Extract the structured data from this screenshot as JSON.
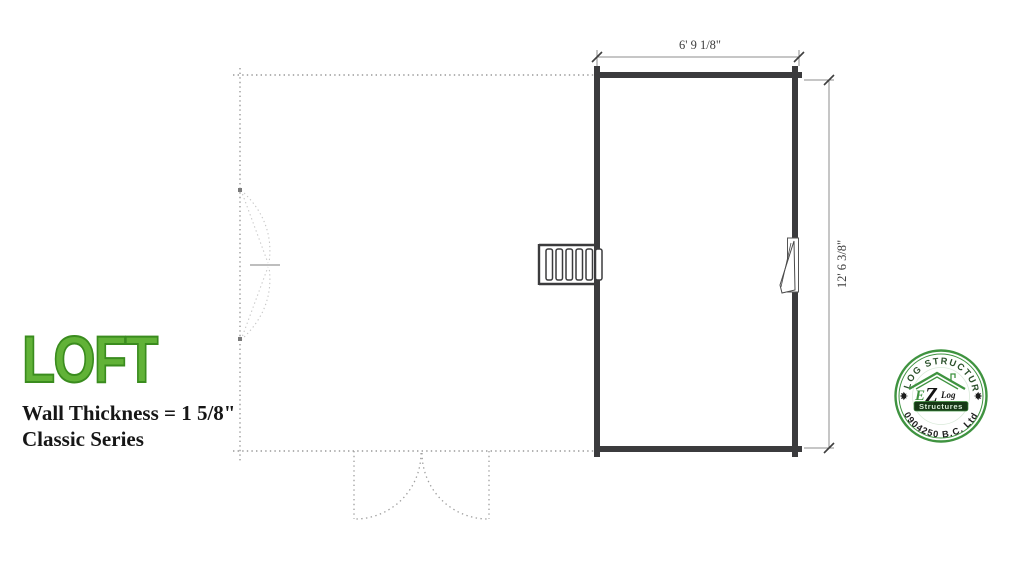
{
  "title": {
    "main": "LOFT",
    "wall_thickness": "Wall Thickness = 1 5/8\"",
    "series": "Classic Series"
  },
  "plan": {
    "dim_top": "6' 9 1/8\"",
    "dim_right": "12' 6 3/8\""
  },
  "stamp": {
    "arc_top": "EZ LOG STRUCTURES",
    "arc_bottom": "0904250 B.C. Ltd",
    "e": "E",
    "z": "Z",
    "log": "Log",
    "banner": "Structures"
  },
  "colors": {
    "title_green": "#61b237",
    "stamp_green": "#3f9340",
    "wall_dark": "#3b3b3d",
    "dashed_gray": "#9a9a9a"
  }
}
